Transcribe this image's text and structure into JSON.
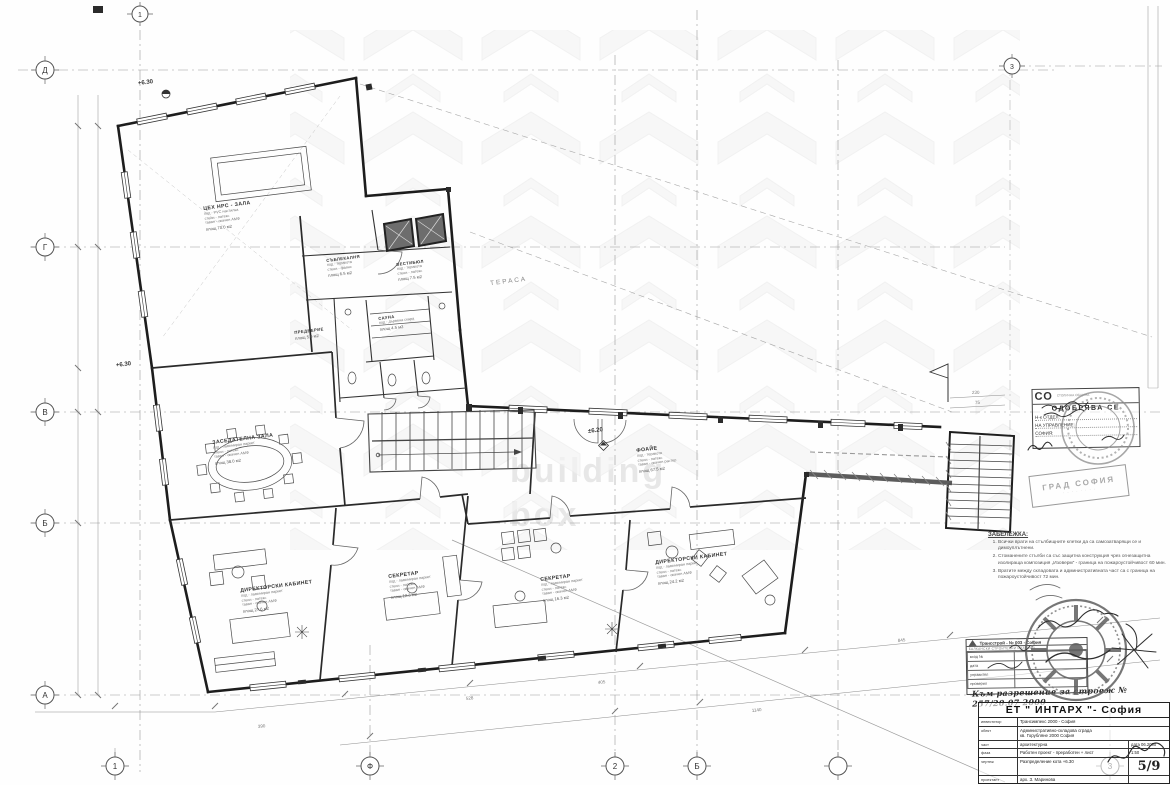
{
  "sheet": {
    "watermark": {
      "line1": "building",
      "line2": "box"
    }
  },
  "plan": {
    "terrace": "ТЕРАСА",
    "elevations": {
      "hall": "+6.30",
      "conf": "+6.30",
      "stair": "±6.20"
    },
    "rooms": {
      "hall": {
        "name": "ЦЕХ НРС - ЗАЛА",
        "l1": "под - PVC настилка",
        "l2": "стени - латекс",
        "l3": "таван - окачен АМФ",
        "area": "площ 70.0 м2"
      },
      "locker": {
        "name": "СЪБЛЕКАЛНЯ",
        "l1": "под - теракота",
        "l2": "стени - фаянс",
        "area": "площ 6.5 м2"
      },
      "vest": {
        "name": "ВЕСТИБЮЛ",
        "l1": "под - теракота",
        "l2": "стени - латекс",
        "area": "площ 7.5 м2"
      },
      "sauna": {
        "name": "САУНА",
        "l1": "под - дървена скара",
        "area": "площ 4.5 м2"
      },
      "pred": {
        "name": "ПРЕДВЕРИЕ",
        "l1": "под - теракота",
        "area": "площ 5.0 м2"
      },
      "conf": {
        "name": "ЗАСЕДАТЕЛНА ЗАЛА",
        "l1": "под - ламиниран паркет",
        "l2": "стени - латекс",
        "l3": "таван - окачен АМФ",
        "area": "площ 38.0 м2"
      },
      "dir1": {
        "name": "ДИРЕКТОРСКИ КАБИНЕТ",
        "l1": "под - ламиниран паркет",
        "l2": "стени - латекс",
        "l3": "таван - окачен АМФ",
        "area": "площ 27.6 м2"
      },
      "sec1": {
        "name": "СЕКРЕТАР",
        "l1": "под - ламиниран паркет",
        "l2": "стени - латекс",
        "l3": "таван - окачен АМФ",
        "area": "площ 12.3 м2"
      },
      "sec2": {
        "name": "СЕКРЕТАР",
        "l1": "под - ламиниран паркет",
        "l2": "стени - латекс",
        "l3": "таван - окачен АМФ",
        "area": "площ 16.3 м2"
      },
      "dir2": {
        "name": "ДИРЕКТОРСКИ КАБИНЕТ",
        "l1": "под - ламиниран паркет",
        "l2": "стени - латекс",
        "l3": "таван - окачен АМФ",
        "area": "площ 24.2 м2"
      },
      "foyer": {
        "name": "ФОАЙЕ",
        "l1": "под - теракота",
        "l2": "стени - латекс",
        "l3": "таван - окачен растер",
        "area": "площ 67.5 м2"
      }
    },
    "grid": {
      "left": [
        "Д",
        "Г",
        "В",
        "Б",
        "А"
      ],
      "bottom": [
        "1",
        "Ф",
        "2",
        "Б",
        "",
        "3"
      ],
      "top": [
        "1",
        "3"
      ]
    },
    "dims": {
      "a": "230",
      "b": "75",
      "c": "528",
      "d": "405",
      "e": "1140",
      "f": "845",
      "g": "390"
    }
  },
  "notes": {
    "title": "ЗАБЕЛЕЖКА:",
    "items": [
      "Всички врати на стълбищните клетки да са самозатварящи се и димоуплътнени.",
      "Стоманените стълби са със защитна конструкция чрез огнезащитна изолираща композиция „Изоверм“ - граница на пожароустойчивост 60 мин.",
      "Вратите между складовата и административната част са с граница на пожароустойчивост 72 мин."
    ]
  },
  "stamps": {
    "approve": {
      "logo": "СО",
      "logo_sub": "СТОЛИЧНА ОБЩИНА",
      "title": "ОДОБРЯВА СЕ",
      "f1": "Н-к ОТДЕЛ:",
      "f2": "НА УПРАВЛЕНИЕ:",
      "f3": "СОФИЯ:"
    },
    "stamp2": {
      "line1": "ГРАД СОФИЯ",
      "line2": "· · · · · · · ·"
    },
    "contractor": {
      "title": "Трансстрой - № 003 - София",
      "subtitle": "БАЛКАНСКИ СТРОИТЕЛНИ ИЗДЕЛИЯ",
      "rows": [
        {
          "label": "вход №"
        },
        {
          "label": "дата"
        },
        {
          "label": "управител"
        },
        {
          "label": "проверил"
        }
      ]
    },
    "permit_line": "Към разрешение за строеж № 257/20.07 2000"
  },
  "titleblock": {
    "company": "ЕТ \" ИНТАРХ \"- София",
    "rows": [
      {
        "label": "инвеститор",
        "value": "Трансимпекс 2000 - София"
      },
      {
        "label": "обект",
        "value": "Административно-складова сграда",
        "value2": "кв. Горубляне 2000 София"
      },
      {
        "label": "част",
        "value": "архитектурна",
        "extra": "дата 06.2000"
      },
      {
        "label": "фаза",
        "value": "Работен проект - преработен + лист",
        "extra": "1:50"
      },
      {
        "label": "чертеж",
        "value": "Разпределение кота +6.30",
        "extra": "5/9"
      },
      {
        "label": "проектант",
        "value": "арх. З. Маринова"
      }
    ]
  }
}
